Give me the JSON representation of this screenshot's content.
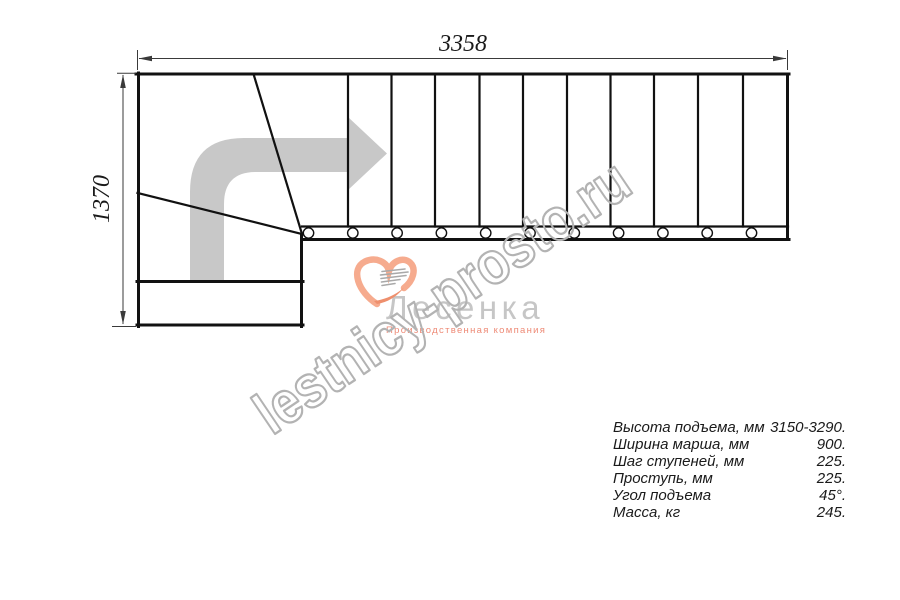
{
  "diagram": {
    "type": "staircase-plan-top-view",
    "dimensions": {
      "width_mm": "3358",
      "height_mm": "1370"
    },
    "plan": {
      "straight_tread_count": 11,
      "step_divider_x": [
        348,
        391.5,
        435,
        479.5,
        523,
        567,
        610.5,
        654,
        698,
        743
      ],
      "baluster_x": [
        308.5,
        352.8,
        397.1,
        441.4,
        485.7,
        530,
        574.3,
        618.6,
        662.9,
        707.2,
        751.5
      ]
    },
    "colors": {
      "line": "#111111",
      "dimension": "#3a3a3a",
      "arrow": "#c8c8c8"
    }
  },
  "watermark": {
    "text": "lestnicy-prosto.ru",
    "color": "#b3b3b3"
  },
  "logo": {
    "company": "Лесенка",
    "tagline": "Производственная компания",
    "company_color": "#c6c6c6",
    "tagline_color": "#ee8a76",
    "mark_primary": "#f6ab8e",
    "mark_accent": "#ee8f6d",
    "mark_lines": "#a9a9a9"
  },
  "specs": {
    "rows": [
      {
        "label": "Высота подъема, мм",
        "value": "3150-3290."
      },
      {
        "label": "Ширина марша, мм",
        "value": "900."
      },
      {
        "label": "Шаг ступеней, мм",
        "value": "225."
      },
      {
        "label": "Проступь, мм",
        "value": "225."
      },
      {
        "label": "Угол подъема",
        "value": "45°."
      },
      {
        "label": "Масса, кг",
        "value": "245."
      }
    ]
  }
}
